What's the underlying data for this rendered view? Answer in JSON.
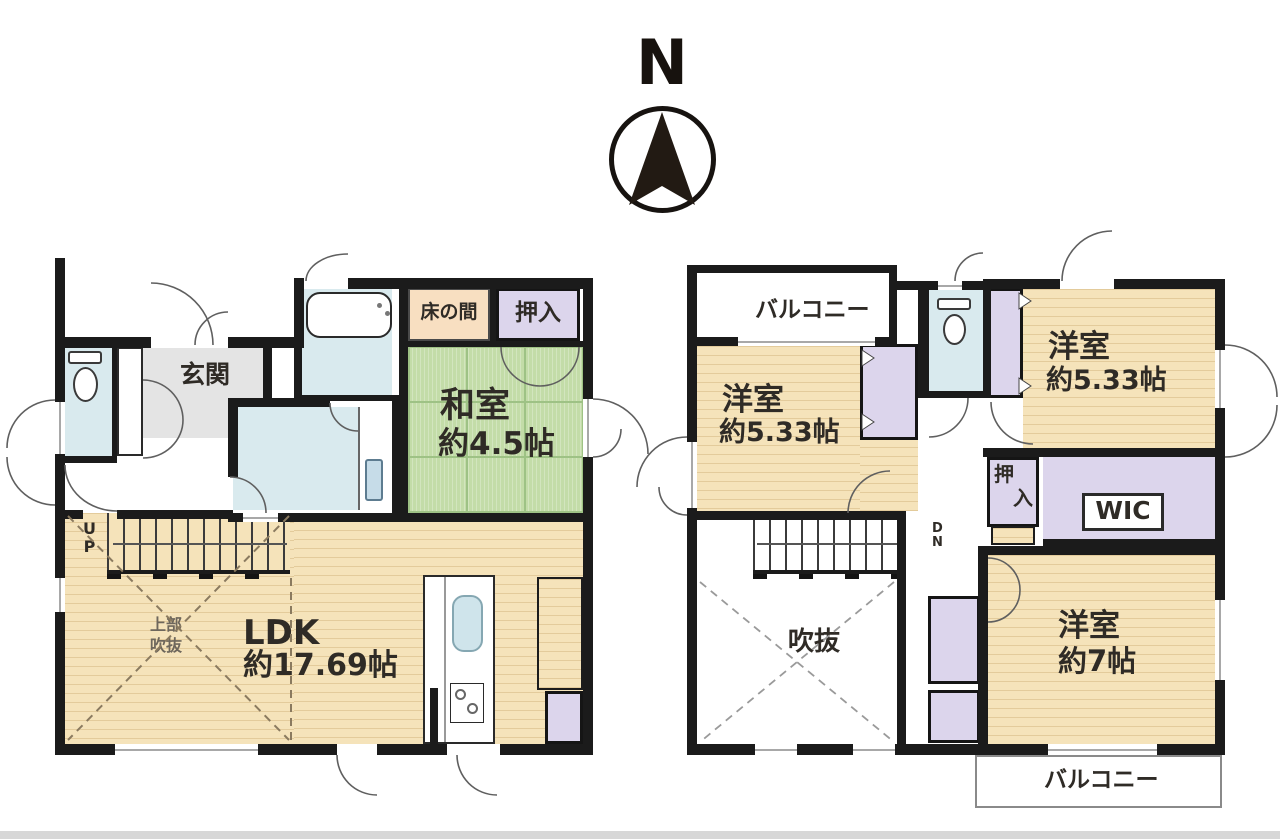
{
  "palette": {
    "wall": "#1b1b1b",
    "wood_floor": "#f5e3ba",
    "tatami_green": "#c3dca8",
    "closet_purple": "#dcd5ec",
    "water_blue": "#d9eaee",
    "genkan_gray": "#e4e4e4",
    "tokonoma_peach": "#f8dfc1"
  },
  "compass": {
    "north_label": "N"
  },
  "floor1": {
    "entrance_label": "玄関",
    "tokonoma_label": "床の間",
    "closet_label": "押入",
    "tatami_room": {
      "name": "和室",
      "size": "約4.5帖"
    },
    "ldk": {
      "name": "LDK",
      "size": "約17.69帖"
    },
    "stairs_chars": [
      "U",
      "P"
    ],
    "void_above_lines": [
      "上部",
      "吹抜"
    ]
  },
  "floor2": {
    "balcony_north_label": "バルコニー",
    "balcony_south_label": "バルコニー",
    "bedroom_nw": {
      "name": "洋室",
      "size": "約5.33帖"
    },
    "bedroom_ne": {
      "name": "洋室",
      "size": "約5.33帖"
    },
    "bedroom_se": {
      "name": "洋室",
      "size": "約7帖"
    },
    "closet_chars": [
      "押",
      "入"
    ],
    "wic_label": "WIC",
    "void_label": "吹抜",
    "stairs_chars": [
      "D",
      "N"
    ]
  }
}
